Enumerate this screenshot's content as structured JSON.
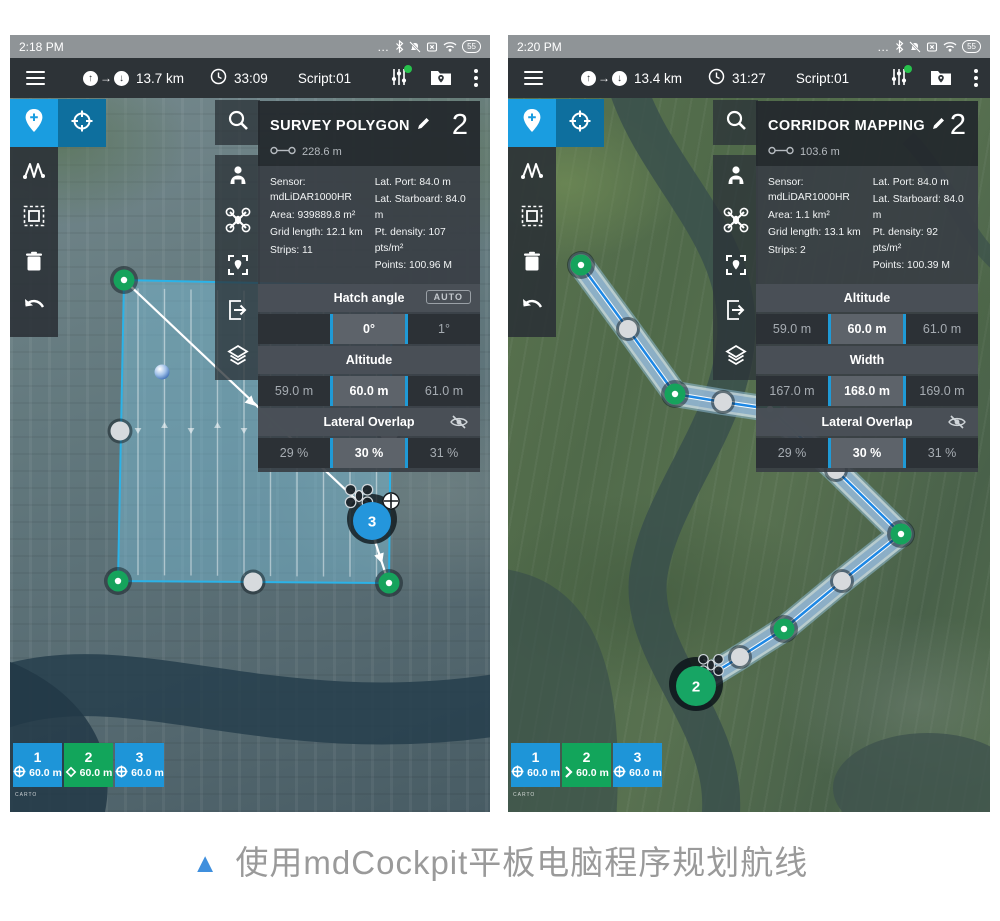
{
  "caption": {
    "marker": "▲",
    "text": "使用mdCockpit平板电脑程序规划航线"
  },
  "screens": [
    {
      "status": {
        "time": "2:18 PM",
        "battery": "55"
      },
      "toolbar": {
        "distance": "13.7 km",
        "duration": "33:09",
        "script": "Script:01"
      },
      "panel": {
        "title": "SURVEY POLYGON",
        "count": "2",
        "spacing": "228.6 m",
        "info_left": [
          "Sensor: mdLiDAR1000HR",
          "Area: 939889.8 m²",
          "Grid length: 12.1 km",
          "Strips: 11"
        ],
        "info_right": [
          "Lat. Port: 84.0 m",
          "Lat. Starboard: 84.0 m",
          "Pt. density: 107 pts/m²",
          "Points: 100.96 M"
        ],
        "params": [
          {
            "label": "Hatch angle",
            "badge": "AUTO",
            "values": [
              "",
              "0°",
              "1°"
            ]
          },
          {
            "label": "Altitude",
            "values": [
              "59.0 m",
              "60.0 m",
              "61.0 m"
            ]
          },
          {
            "label": "Lateral Overlap",
            "eye": true,
            "values": [
              "29 %",
              "30 %",
              "31 %"
            ]
          }
        ]
      },
      "marker_label": "3",
      "waypoints": [
        {
          "num": "1",
          "alt": "60.0 m",
          "color": "#1e95d8",
          "icon": "crosshair"
        },
        {
          "num": "2",
          "alt": "60.0 m",
          "color": "#12a55b",
          "icon": "diamond"
        },
        {
          "num": "3",
          "alt": "60.0 m",
          "color": "#1e95d8",
          "icon": "crosshair"
        }
      ],
      "attribution": "CARTO"
    },
    {
      "status": {
        "time": "2:20 PM",
        "battery": "55"
      },
      "toolbar": {
        "distance": "13.4 km",
        "duration": "31:27",
        "script": "Script:01"
      },
      "panel": {
        "title": "CORRIDOR MAPPING",
        "count": "2",
        "spacing": "103.6 m",
        "info_left": [
          "Sensor: mdLiDAR1000HR",
          "Area: 1.1 km²",
          "Grid length: 13.1 km",
          "Strips: 2"
        ],
        "info_right": [
          "Lat. Port: 84.0 m",
          "Lat. Starboard: 84.0 m",
          "Pt. density: 92 pts/m²",
          "Points: 100.39 M"
        ],
        "params": [
          {
            "label": "Altitude",
            "values": [
              "59.0 m",
              "60.0 m",
              "61.0 m"
            ]
          },
          {
            "label": "Width",
            "values": [
              "167.0 m",
              "168.0 m",
              "169.0 m"
            ]
          },
          {
            "label": "Lateral Overlap",
            "eye": true,
            "values": [
              "29 %",
              "30 %",
              "31 %"
            ]
          }
        ]
      },
      "marker_label": "2",
      "waypoints": [
        {
          "num": "1",
          "alt": "60.0 m",
          "color": "#1e95d8",
          "icon": "crosshair"
        },
        {
          "num": "2",
          "alt": "60.0 m",
          "color": "#12a55b",
          "icon": "chevron"
        },
        {
          "num": "3",
          "alt": "60.0 m",
          "color": "#1e95d8",
          "icon": "crosshair"
        }
      ],
      "attribution": "CARTO",
      "attribution2": "©Baidu"
    }
  ]
}
